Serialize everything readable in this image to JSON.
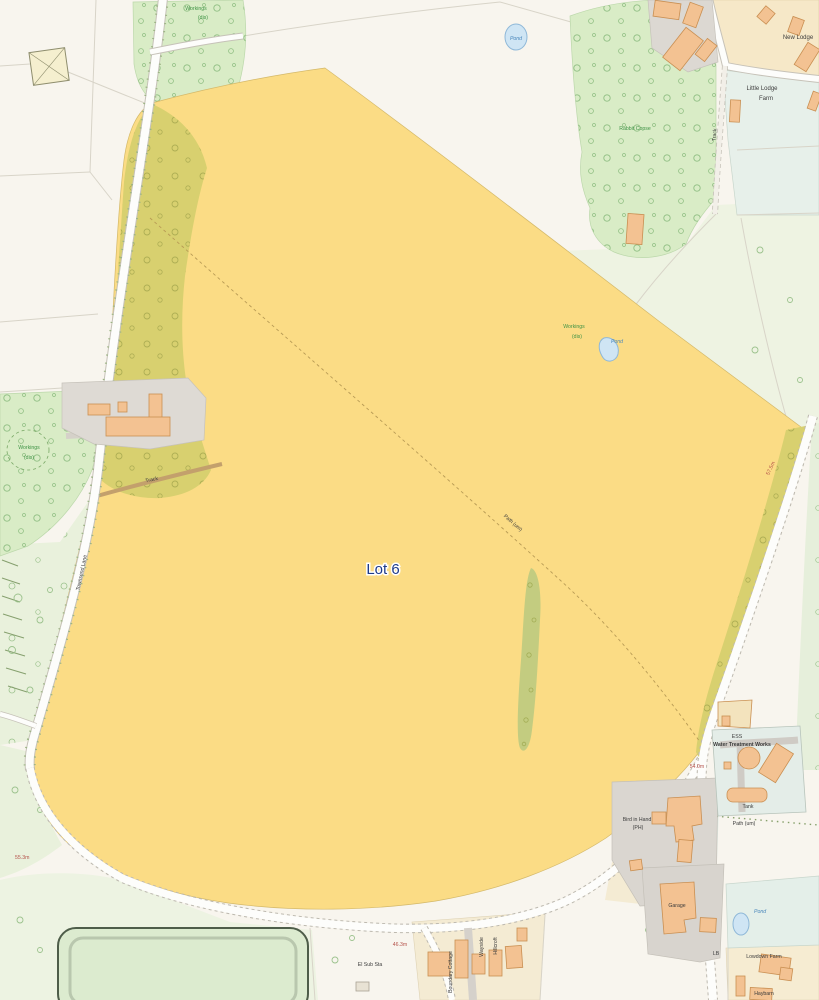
{
  "map": {
    "lot": {
      "name": "Lot 6"
    },
    "woods": {
      "rabbit_copse": "Rabbit Copse",
      "workings": "Workings",
      "workings_dis": "(dis)"
    },
    "water": {
      "pond": "Pond"
    },
    "roads": {
      "townsend_lane": "Townsend Lane",
      "track": "Track",
      "path_um": "Path (um)"
    },
    "places": {
      "new_lodge": "New Lodge",
      "little_lodge": "Little Lodge",
      "little_lodge_2": "Farm",
      "ess": "ESS",
      "wtw": "Water Treatment Works",
      "tank": "Tank",
      "bird_in_hand": "Bird in Hand",
      "bird_in_hand_2": "(PH)",
      "garage": "Garage",
      "lb": "LB",
      "lowdown_farm": "Lowdown Farm",
      "haybarn": "Haybarn",
      "el_sub_sta": "El Sub Sta",
      "boundary_cottage": "Boundary Cottage",
      "wayside": "Wayside",
      "hillcroft": "Hillcroft"
    },
    "heights": {
      "h_57_5": "57.5m",
      "h_54_0": "54.0m",
      "h_46_3": "46.3m",
      "h_55_3": "55.3m"
    },
    "colors": {
      "lot_fill": "#fbdc85",
      "woodland": "#d9ecc6",
      "olive_overlap": "#d8d06f",
      "water": "#cfe5f4",
      "building": "#f3c292",
      "road": "#ffffff",
      "label_green": "#3f9345",
      "label_blue": "#4a87bb",
      "label_red": "#b5524a",
      "lot_label_color": "#1e3a8a"
    }
  }
}
